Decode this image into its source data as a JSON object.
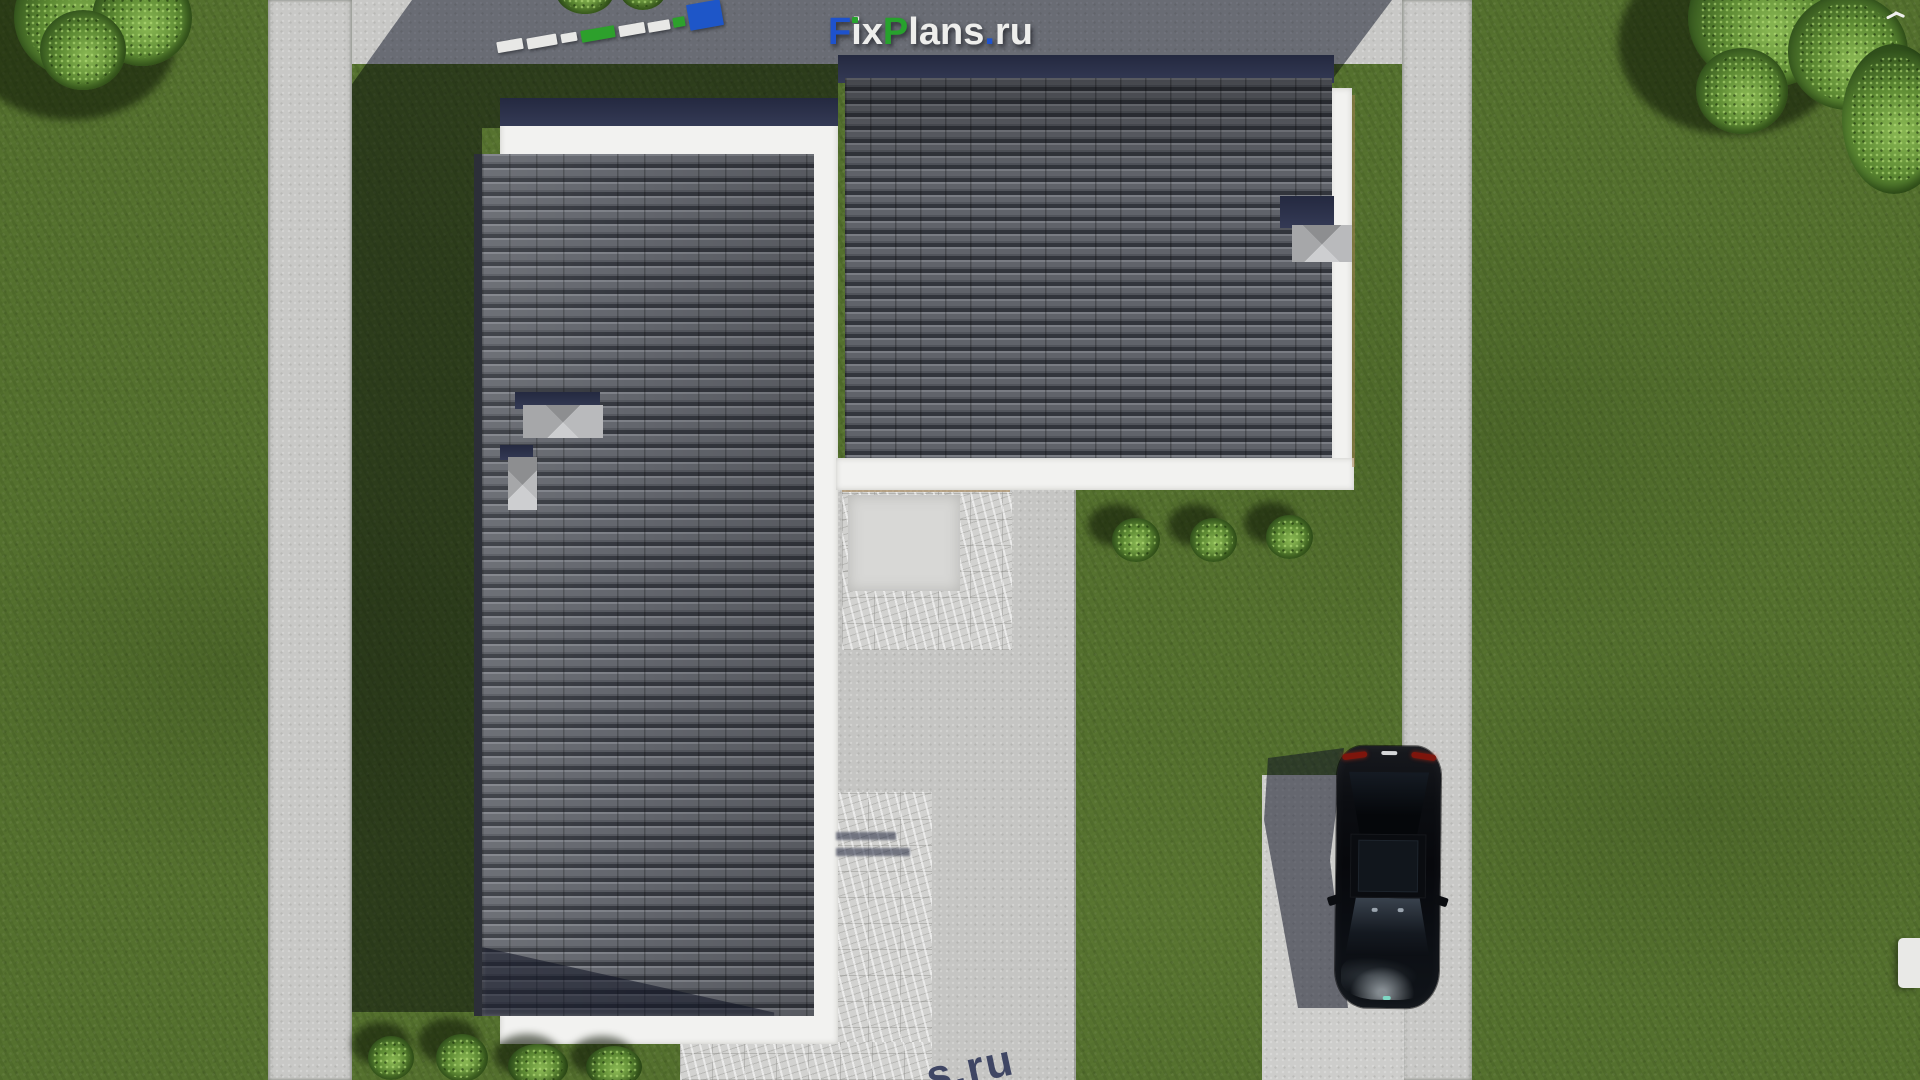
{
  "brand": {
    "name": "FixPlans.ru",
    "letters": [
      {
        "ch": "F",
        "color": "#1e52cc"
      },
      {
        "ch": "i",
        "color": "#eeeeec",
        "dot": "#27a22d"
      },
      {
        "ch": "x",
        "color": "#eeeeec"
      },
      {
        "ch": "P",
        "color": "#27a22d"
      },
      {
        "ch": "l",
        "color": "#eeeeec"
      },
      {
        "ch": "a",
        "color": "#eeeeec"
      },
      {
        "ch": "n",
        "color": "#eeeeec"
      },
      {
        "ch": "s",
        "color": "#eeeeec"
      },
      {
        "ch": ".",
        "color": "#1e52cc"
      },
      {
        "ch": "r",
        "color": "#eeeeec"
      },
      {
        "ch": "u",
        "color": "#eeeeec"
      }
    ]
  },
  "watermarks": {
    "bottom_fragment_text": "s.ru",
    "bottom_fragment_color": "#343c5c",
    "top_left_blocks": [
      {
        "x": 497,
        "y": 40,
        "w": 26,
        "h": 11,
        "c": "#e8e8e6"
      },
      {
        "x": 527,
        "y": 36,
        "w": 30,
        "h": 11,
        "c": "#e8e8e6"
      },
      {
        "x": 561,
        "y": 33,
        "w": 16,
        "h": 9,
        "c": "#e8e8e6"
      },
      {
        "x": 581,
        "y": 28,
        "w": 34,
        "h": 12,
        "c": "#2da02c"
      },
      {
        "x": 619,
        "y": 24,
        "w": 26,
        "h": 11,
        "c": "#e8e8e6"
      },
      {
        "x": 648,
        "y": 21,
        "w": 22,
        "h": 10,
        "c": "#e8e8e6"
      },
      {
        "x": 673,
        "y": 17,
        "w": 12,
        "h": 10,
        "c": "#2da02c"
      },
      {
        "x": 688,
        "y": 2,
        "w": 34,
        "h": 26,
        "c": "#1e56c8"
      }
    ]
  },
  "palette": {
    "grass": "#54702e",
    "grass_mottle_dark": "#1c2c0a",
    "pavement": "#c8c8c6",
    "marble_paving": "#d2d2d0",
    "shadow_cast": "rgba(23,29,52,0.52)",
    "roof_tile": "#63666d",
    "roof_tile_gap": "#34373e",
    "roof_eave_navy": "#2b3147",
    "fascia_white": "#f2f2f0",
    "trim_tan": "#a5814f",
    "skylight_cap": "#a8a9ab",
    "bush_light": "#85b350",
    "bush_dark": "#31511c",
    "car_body": "#0a0c10",
    "car_taillight": "#7e150c",
    "car_glass": "#39424d",
    "car_teal_badge": "#7fd8c4"
  },
  "scene": {
    "description": "Top-down aerial 3D render of an L-shaped house plan with dark tiled shed roofs, white fascia borders, concrete patio and walkways, left sidewalk, right road with parked black sedan, lawn, bushes and trees; FixPlans.ru watermarks.",
    "elements": [
      "left-wing-roof",
      "right-wing-roof",
      "skylight-large",
      "skylight-small",
      "chimney-cap",
      "patio",
      "marble-walkway",
      "garden-steps",
      "sidewalk-left",
      "top-walkway",
      "road-right",
      "parking-pad",
      "black-car",
      "bushes-row",
      "bushes-bottom",
      "trees-top-left",
      "trees-top-right",
      "house-shadow",
      "white-bin",
      "bird"
    ]
  }
}
